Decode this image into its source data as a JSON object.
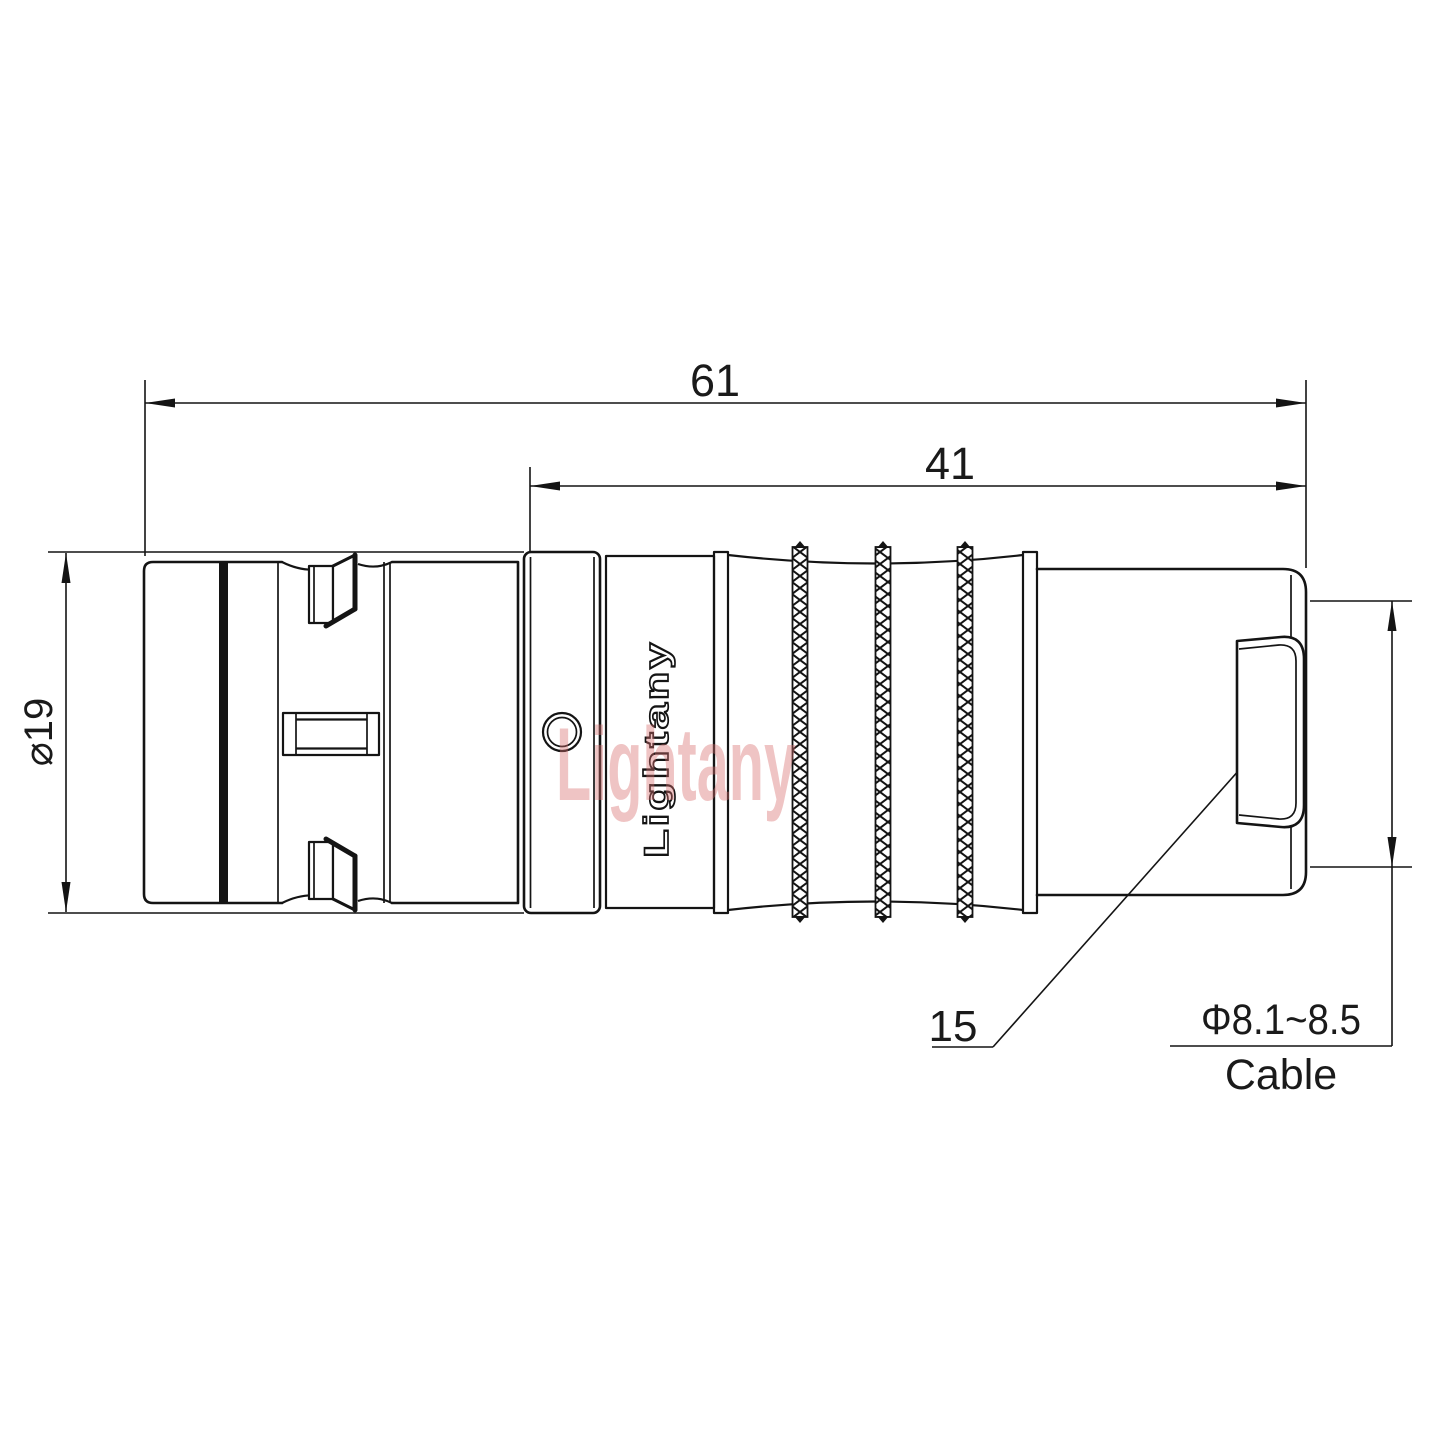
{
  "drawing": {
    "title_context": "connector-technical-drawing",
    "dimensions": {
      "overall_length": "61",
      "rear_section_length": "41",
      "body_diameter": "⌀19",
      "cable_diameter_range": "Φ8.1~8.5",
      "cable_word": "Cable",
      "item_callout": "15"
    },
    "branding": {
      "logo_text": "Lightany",
      "watermark_text": "Lightany"
    },
    "colors": {
      "line_color": "#141414",
      "watermark_pink": "#d86e6e",
      "background": "#ffffff"
    }
  }
}
